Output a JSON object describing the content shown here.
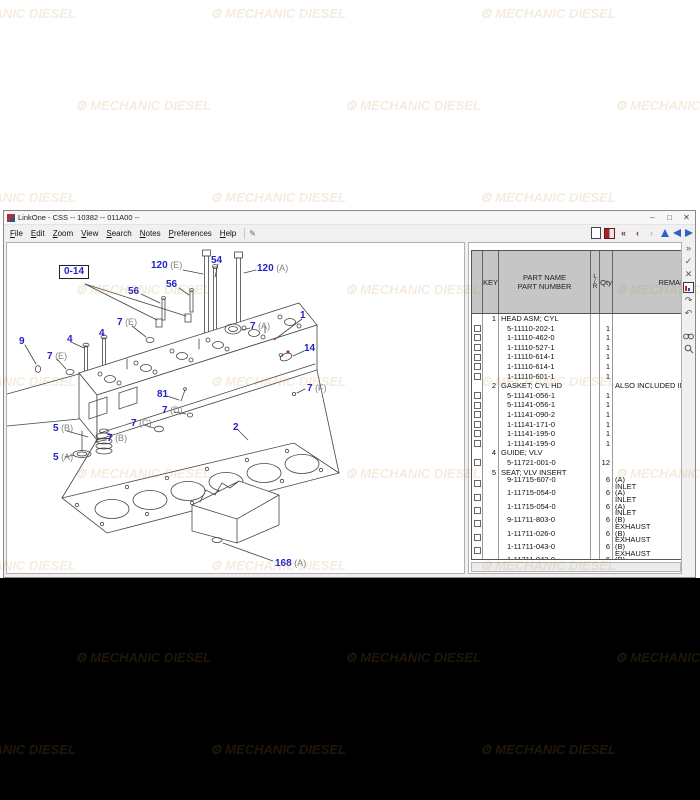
{
  "window": {
    "title": "LinkOne - CSS -- 10382 -- 011A00 --",
    "buttons": [
      "–",
      "□",
      "✕"
    ]
  },
  "menu": {
    "items": [
      "File",
      "Edit",
      "Zoom",
      "View",
      "Search",
      "Notes",
      "Preferences",
      "Help"
    ]
  },
  "icons": {
    "note": "✎",
    "first": "«",
    "previous": "‹",
    "next": "›",
    "go": "»",
    "accept": "✓",
    "cancel": "✕",
    "redo": "↷",
    "undo": "↶"
  },
  "colors": {
    "label_blue": "#2222cc",
    "label_suffix_gray": "#808080",
    "red_dot": "#cc2222",
    "watermark": "#c3873c"
  },
  "watermark": {
    "text": "MECHANIC DIESEL"
  },
  "table": {
    "headers": {
      "key": "KEY",
      "name1": "PART NAME",
      "name2": "PART NUMBER",
      "l": "L",
      "slash": "/",
      "r": "R",
      "qty": "Qty",
      "remarks": "REMARKS"
    },
    "rows": [
      {
        "type": "group",
        "key": "1",
        "name": "HEAD ASM; CYL"
      },
      {
        "type": "part",
        "number": "5-11110-202-1",
        "qty": "1",
        "cb": true
      },
      {
        "type": "part",
        "number": "1-11110-462-0",
        "qty": "1",
        "cb": true
      },
      {
        "type": "part",
        "number": "1-11110-527-1",
        "qty": "1",
        "cb": true
      },
      {
        "type": "part",
        "number": "1-11110-614-1",
        "qty": "1",
        "cb": true
      },
      {
        "type": "part",
        "number": "1-11110-614-1",
        "qty": "1",
        "cb": true
      },
      {
        "type": "part",
        "number": "1-11110-601-1",
        "qty": "1",
        "cb": true
      },
      {
        "type": "group",
        "key": "2",
        "name": "GASKET; CYL HD",
        "remark": "ALSO INCLUDED IN G"
      },
      {
        "type": "part",
        "number": "5-11141-056-1",
        "qty": "1",
        "cb": true
      },
      {
        "type": "part",
        "number": "5-11141-056-1",
        "qty": "1",
        "cb": true
      },
      {
        "type": "part",
        "number": "1-11141-090-2",
        "qty": "1",
        "cb": true
      },
      {
        "type": "part",
        "number": "1-11141-171-0",
        "qty": "1",
        "cb": true
      },
      {
        "type": "part",
        "number": "1-11141-195-0",
        "qty": "1",
        "cb": true
      },
      {
        "type": "part",
        "number": "1-11141-195-0",
        "qty": "1",
        "cb": true
      },
      {
        "type": "group",
        "key": "4",
        "name": "GUIDE; VLV"
      },
      {
        "type": "part",
        "number": "5-11721-001-0",
        "qty": "12",
        "cb": true
      },
      {
        "type": "group",
        "key": "5",
        "name": "SEAT; VLV INSERT"
      },
      {
        "type": "part",
        "number": "9-11715-607-0",
        "qty": "6",
        "remark": "(A)",
        "remark2": "INLET",
        "cb": true,
        "tall": true
      },
      {
        "type": "part",
        "number": "1-11715-054-0",
        "qty": "6",
        "remark": "(A)",
        "remark2": "INLET",
        "cb": true,
        "tall": true
      },
      {
        "type": "part",
        "number": "1-11715-054-0",
        "qty": "6",
        "remark": "(A)",
        "remark2": "INLET",
        "cb": true,
        "tall": true
      },
      {
        "type": "part",
        "number": "9-11711-803-0",
        "qty": "6",
        "remark": "(B)",
        "remark2": "EXHAUST",
        "cb": true,
        "tall": true
      },
      {
        "type": "part",
        "number": "1-11711-026-0",
        "qty": "6",
        "remark": "(B)",
        "remark2": "EXHAUST",
        "cb": true,
        "tall": true
      },
      {
        "type": "part",
        "number": "1-11711-043-0",
        "qty": "6",
        "remark": "(B)",
        "remark2": "EXHAUST",
        "cb": true,
        "tall": true
      },
      {
        "type": "part",
        "number": "1-11711-043-0",
        "qty": "6",
        "remark": "(B)",
        "remark2": "EXHAUST",
        "cb": true,
        "tall": true
      },
      {
        "type": "group",
        "key": "7",
        "name": "CUP; SEALING,CYL HEAD"
      },
      {
        "type": "part",
        "number": "1-09600-005-1",
        "qty": "1",
        "remark": "(A)",
        "remark2": "OD=45",
        "cb": true,
        "tall": true
      }
    ]
  },
  "diagram": {
    "labels": [
      {
        "t": "0-14",
        "box": true,
        "x": 52,
        "y": 22
      },
      {
        "t": "120",
        "s": "(E)",
        "x": 144,
        "y": 18
      },
      {
        "t": "54",
        "x": 204,
        "y": 13
      },
      {
        "t": "120",
        "s": "(A)",
        "x": 250,
        "y": 21
      },
      {
        "t": "56",
        "x": 121,
        "y": 44
      },
      {
        "t": "56",
        "x": 159,
        "y": 37
      },
      {
        "t": "7",
        "s": "(E)",
        "x": 110,
        "y": 75
      },
      {
        "t": "1",
        "x": 293,
        "y": 68
      },
      {
        "t": "7",
        "s": "(A)",
        "x": 243,
        "y": 79
      },
      {
        "t": "9",
        "x": 12,
        "y": 94
      },
      {
        "t": "4",
        "x": 92,
        "y": 86
      },
      {
        "t": "4",
        "x": 60,
        "y": 92
      },
      {
        "t": "7",
        "s": "(E)",
        "x": 40,
        "y": 109
      },
      {
        "t": "14",
        "x": 297,
        "y": 101
      },
      {
        "t": "81",
        "x": 150,
        "y": 147
      },
      {
        "t": "7",
        "s": "(D)",
        "x": 155,
        "y": 163
      },
      {
        "t": "7",
        "s": "(C)",
        "x": 124,
        "y": 176
      },
      {
        "t": "5",
        "s": "(B)",
        "x": 46,
        "y": 181
      },
      {
        "t": "7",
        "s": "(B)",
        "x": 100,
        "y": 191
      },
      {
        "t": "5",
        "s": "(A)",
        "x": 46,
        "y": 210
      },
      {
        "t": "2",
        "x": 226,
        "y": 180
      },
      {
        "t": "7",
        "s": "(F)",
        "x": 300,
        "y": 141
      },
      {
        "t": "168",
        "s": "(A)",
        "x": 268,
        "y": 316
      }
    ]
  }
}
